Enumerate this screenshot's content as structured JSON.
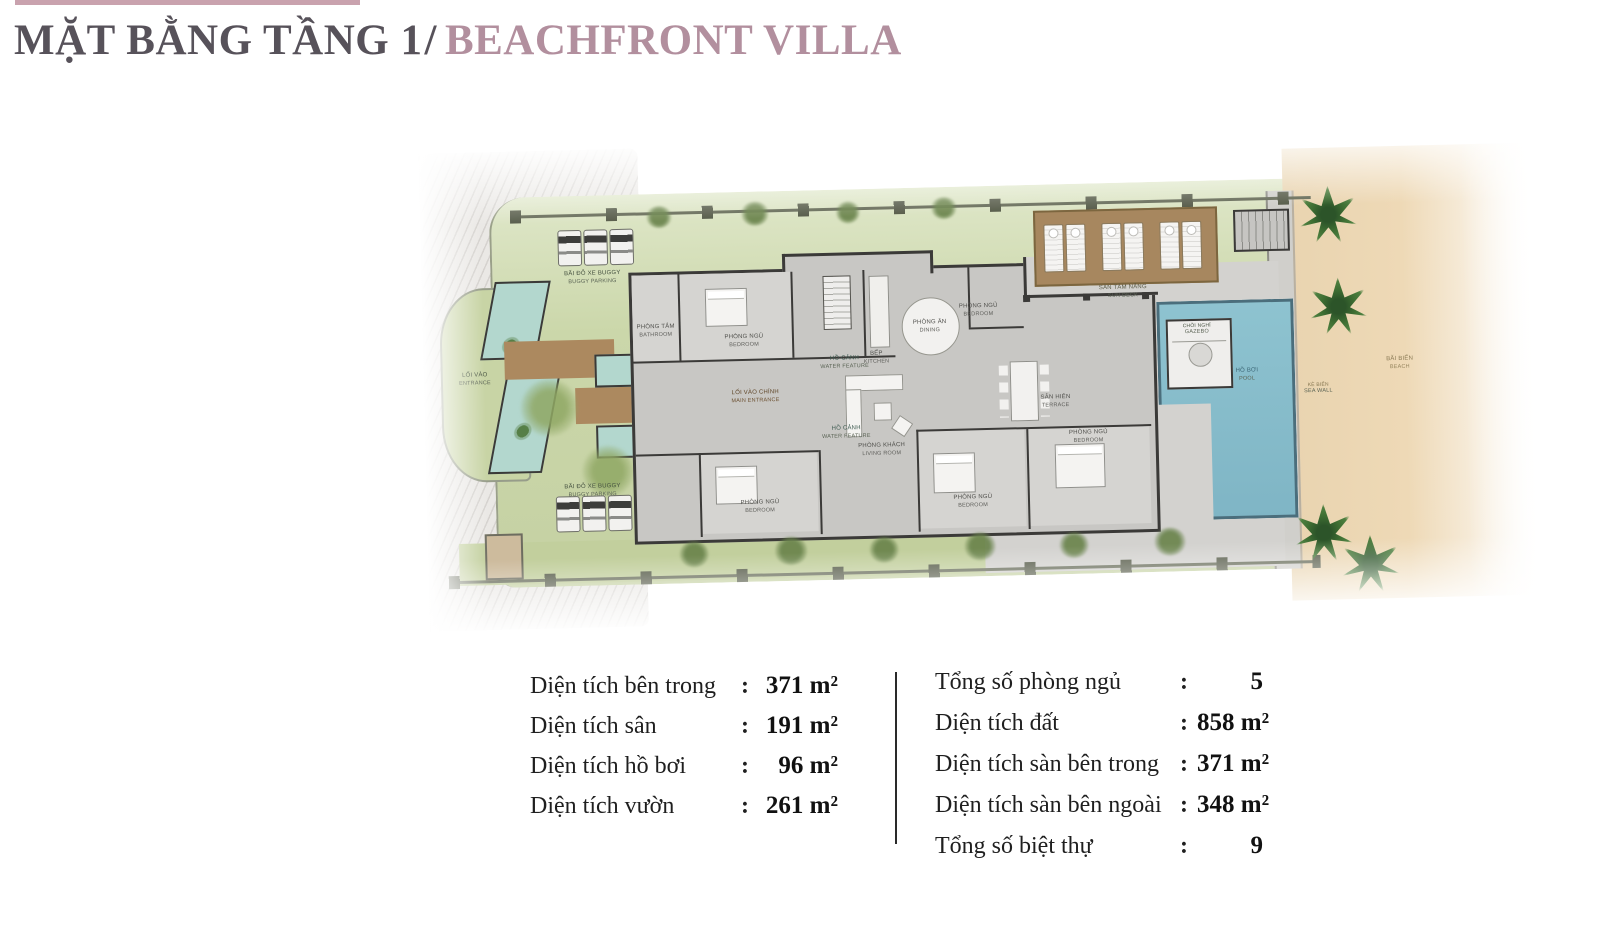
{
  "header": {
    "accent_bar_color": "#c9a2ae",
    "title": {
      "main": "MẶT BẰNG TẦNG 1",
      "separator": "/",
      "sub": "BEACHFRONT VILLA"
    },
    "title_main_color": "#57525a",
    "title_sub_color": "#b28f9e"
  },
  "plan": {
    "labels": {
      "buggy_top": {
        "vi": "BÃI ĐỖ XE BUGGY",
        "en": "BUGGY PARKING"
      },
      "buggy_bottom": {
        "vi": "BÃI ĐỖ XE BUGGY",
        "en": "BUGGY PARKING"
      },
      "entrance_gate": {
        "vi": "LỐI VÀO",
        "en": "ENTRANCE"
      },
      "water_top": {
        "vi": "HỒ CẢNH",
        "en": "WATER FEATURE"
      },
      "water_bottom": {
        "vi": "HỒ CẢNH",
        "en": "WATER FEATURE"
      },
      "main_walkway": {
        "vi": "LỐI VÀO CHÍNH",
        "en": "MAIN ENTRANCE"
      },
      "bathroom_top": {
        "vi": "PHÒNG TẮM",
        "en": "BATHROOM"
      },
      "bedroom_top_left": {
        "vi": "PHÒNG NGỦ",
        "en": "BEDROOM"
      },
      "kitchen": {
        "vi": "BẾP",
        "en": "KITCHEN"
      },
      "dining": {
        "vi": "PHÒNG ĂN",
        "en": "DINING"
      },
      "bedroom_top_right": {
        "vi": "PHÒNG NGỦ",
        "en": "BEDROOM"
      },
      "living": {
        "vi": "PHÒNG KHÁCH",
        "en": "LIVING ROOM"
      },
      "terrace": {
        "vi": "SÂN HIÊN",
        "en": "TERRACE"
      },
      "bedroom_bottom_left": {
        "vi": "PHÒNG NGỦ",
        "en": "BEDROOM"
      },
      "bedroom_bottom_mid": {
        "vi": "PHÒNG NGỦ",
        "en": "BEDROOM"
      },
      "bedroom_master": {
        "vi": "PHÒNG NGỦ",
        "en": "BEDROOM"
      },
      "sun_deck": {
        "vi": "SÀN TẮM NẮNG",
        "en": "SUN DECK"
      },
      "gazebo": {
        "vi": "CHÒI NGHỈ",
        "en": "GAZEBO"
      },
      "pool": {
        "vi": "HỒ BƠI",
        "en": "POOL"
      },
      "sea_wall": {
        "vi": "KÈ BIỂN",
        "en": "SEA WALL"
      },
      "beach": {
        "vi": "BÃI BIỂN",
        "en": "BEACH"
      }
    },
    "colors": {
      "lawn": "#c9d5a8",
      "road": "#eae8e5",
      "villa_floor": "#c8c7c4",
      "walls": "#3b3a38",
      "water": "#b3d7ce",
      "walkway": "#ac895f",
      "deck": "#a7875f",
      "pool": "#86bdcb",
      "sand": "#ebd6b2",
      "palm": "#33602e"
    }
  },
  "stats": {
    "colon": ":",
    "left": [
      {
        "label": "Diện tích bên trong",
        "value": "371 m²"
      },
      {
        "label": "Diện tích sân",
        "value": "191 m²"
      },
      {
        "label": "Diện tích hồ bơi",
        "value": "96 m²"
      },
      {
        "label": "Diện tích vườn",
        "value": "261 m²"
      }
    ],
    "right": [
      {
        "label": "Tổng số phòng ngủ",
        "value": "5"
      },
      {
        "label": "Diện tích đất",
        "value": "858 m²"
      },
      {
        "label": "Diện tích sàn bên trong",
        "value": "371 m²"
      },
      {
        "label": "Diện tích sàn bên ngoài",
        "value": "348 m²"
      },
      {
        "label": "Tổng số biệt thự",
        "value": "9"
      }
    ]
  }
}
